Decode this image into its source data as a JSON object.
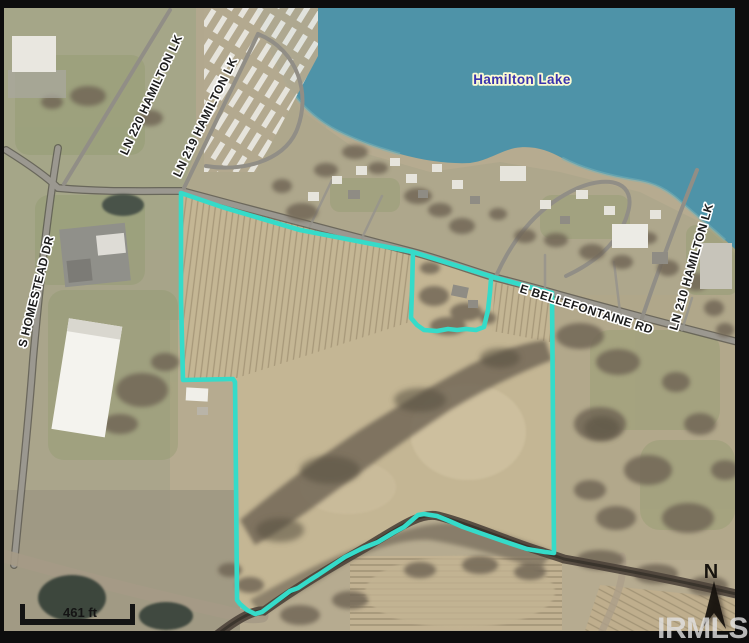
{
  "labels": {
    "lake": "Hamilton Lake",
    "homestead": "S HOMESTEAD DR",
    "ln220": "LN 220 HAMILTON LK",
    "ln219": "LN 219 HAMILTON LK",
    "bellefontaine": "E BELLEFONTAINE RD",
    "ln210": "LN 210 HAMILTON LK"
  },
  "scale_bar": {
    "label": "461 ft"
  },
  "compass": {
    "label": "N"
  },
  "watermark": {
    "label": "IRMLS"
  },
  "colors": {
    "boundary": "#35dbc9",
    "lake": "#4e93a8",
    "lake_label": "#3a34ae",
    "road_label": "#1c1c1c",
    "frame": "#0d0d0d"
  }
}
